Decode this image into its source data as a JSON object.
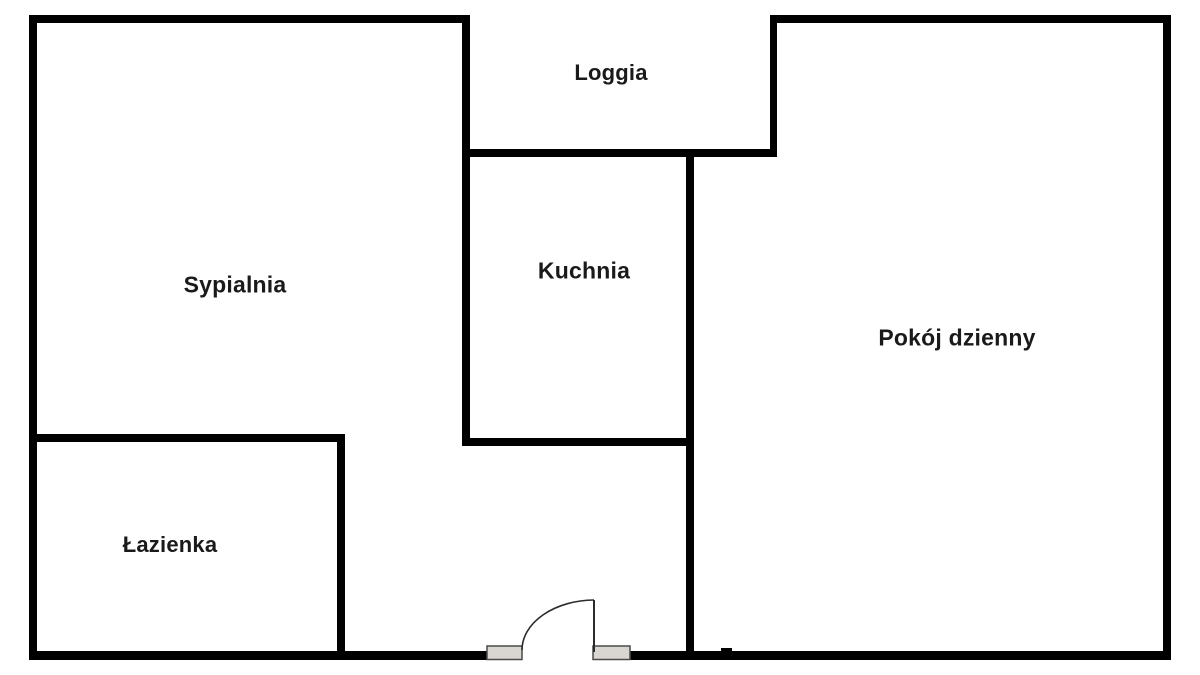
{
  "rooms": {
    "loggia": {
      "label": "Loggia"
    },
    "sypialnia": {
      "label": "Sypialnia"
    },
    "kuchnia": {
      "label": "Kuchnia"
    },
    "pokoj_dzienny": {
      "label": "Pokój dzienny"
    },
    "lazienka": {
      "label": "Łazienka"
    }
  },
  "colors": {
    "wall": "#000000",
    "background": "#ffffff",
    "label_text": "#1a1a1a",
    "door_jamb_fill": "#d9d6d2",
    "door_jamb_border": "#4a4a4a",
    "door_line": "#2b2b2b"
  }
}
